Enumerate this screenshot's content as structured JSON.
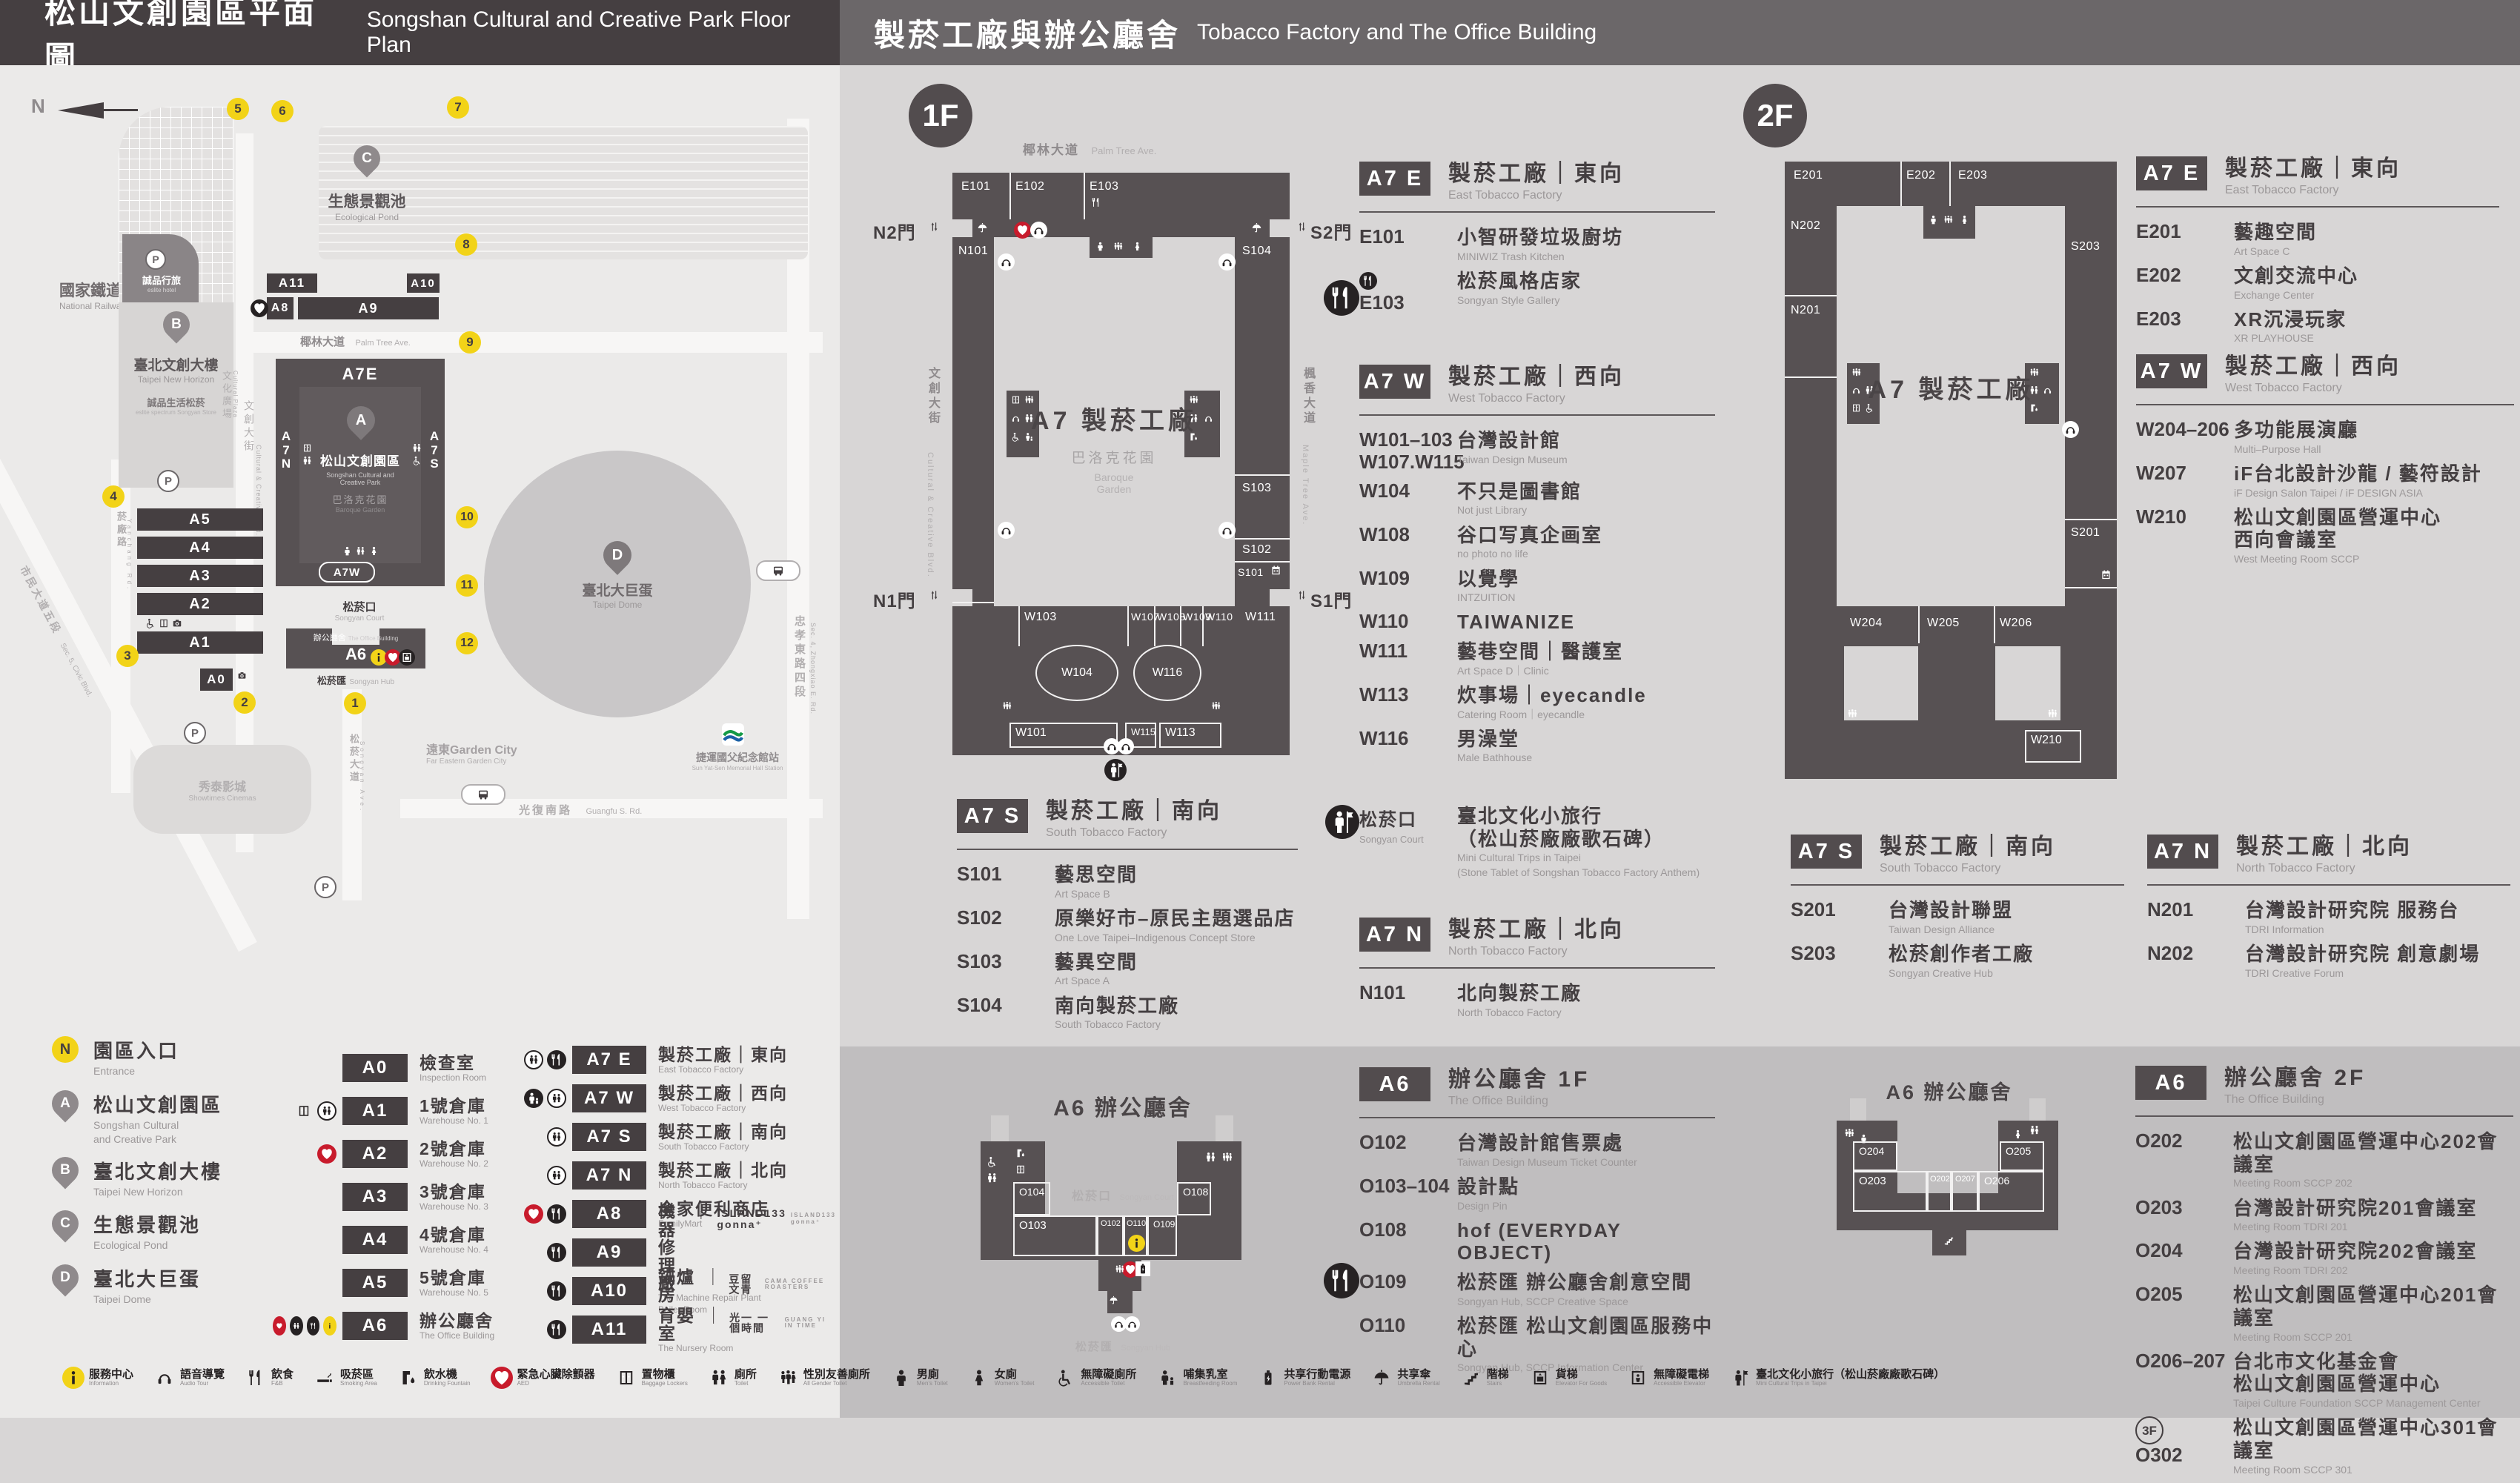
{
  "header": {
    "left_zh": "松山文創園區平面圖",
    "left_en": "Songshan Cultural and Creative Park Floor Plan",
    "right_zh": "製菸工廠與辦公廳舍",
    "right_en": "Tobacco Factory and The Office Building"
  },
  "map": {
    "north": "N",
    "railway_zh": "國家鐵道博物館",
    "railway_en": "National Railway Museum",
    "pond_zh": "生態景觀池",
    "pond_en": "Ecological Pond",
    "hotel_zh": "誠品行旅",
    "hotel_en": "eslite hotel",
    "b_zh": "臺北文創大樓",
    "b_en": "Taipei New Horizon",
    "spectrum_zh": "誠品生活松菸",
    "spectrum_en": "eslite spectrum Songyan Store",
    "plaza_zh": "文化廣場",
    "plaza_en": "Cultural Plaza",
    "ccb_zh": "文創大街",
    "ccb_en": "Cultural & Creative Blvd.",
    "palm_zh": "椰林大道",
    "palm_en": "Palm Tree Ave.",
    "park_zh": "松山文創園區",
    "park_en1": "Songshan Cultural and",
    "park_en2": "Creative Park",
    "baroque_zh": "巴洛克花園",
    "baroque_en": "Baroque Garden",
    "court_zh": "松菸口",
    "court_en": "Songyan Court",
    "office_zh": "辦公廳舍",
    "office_en": "The Office Building",
    "hub_zh": "松菸匯",
    "hub_en": "Songyan Hub",
    "dome_zh": "臺北大巨蛋",
    "dome_en": "Taipei Dome",
    "garden_city_zh": "遠東Garden City",
    "garden_city_en": "Far Eastern Garden City",
    "cinema_zh": "秀泰影城",
    "cinema_en": "Showtimes Cinemas",
    "mrt_zh": "捷運國父紀念館站",
    "mrt_en": "Sun Yat-Sen Memorial Hall Station",
    "guangfu_zh": "光復南路",
    "guangfu_en": "Guangfu S. Rd.",
    "zhongxiao_zh": "忠孝東路四段",
    "zhongxiao_en": "Sec. 4, Zhongxiao E. Rd.",
    "yanchang_zh": "菸廠路",
    "yanchang_en": "Yanchang Rd.",
    "civic_zh": "市民大道五段",
    "civic_en": "Sec. 5, Civic Blvd.",
    "songyan_ave_zh": "松菸大道",
    "songyan_ave_en": "Songyan Ave.",
    "a7e": "A7E",
    "a7w": "A7W",
    "a7n": "A7N",
    "a7s": "A7S",
    "bars": {
      "a0": "A0",
      "a1": "A1",
      "a2": "A2",
      "a3": "A3",
      "a4": "A4",
      "a5": "A5",
      "a6": "A6",
      "a8": "A8",
      "a9": "A9",
      "a10": "A10",
      "a11": "A11"
    },
    "pins": {
      "a": "A",
      "b": "B",
      "c": "C",
      "d": "D"
    },
    "gates": [
      "1",
      "2",
      "3",
      "4",
      "5",
      "6",
      "7",
      "8",
      "9",
      "10",
      "11",
      "12"
    ],
    "p": "P"
  },
  "floor1": {
    "badge": "1F",
    "street_top_zh": "椰林大道",
    "street_top_en": "Palm Tree Ave.",
    "street_left_zh": "文創大街",
    "street_left_en": "Cultural & Creative Blvd.",
    "street_right_zh": "楓香大道",
    "street_right_en": "Maple Tree Ave.",
    "gate_n2": "N2門",
    "gate_s2": "S2門",
    "gate_n1": "N1門",
    "gate_s1": "S1門",
    "plan_title": "A7 製菸工廠",
    "garden_zh": "巴洛克花園",
    "garden_en1": "Baroque",
    "garden_en2": "Garden",
    "plan": {
      "E101": "E101",
      "E102": "E102",
      "E103": "E103",
      "N101": "N101",
      "S101": "S101",
      "S102": "S102",
      "S103": "S103",
      "S104": "S104",
      "W101": "W101",
      "W102": "W102",
      "W103": "W103",
      "W104": "W104",
      "W107": "W107",
      "W108": "W108",
      "W109": "W109",
      "W110": "W110",
      "W111": "W111",
      "W113": "W113",
      "W115": "W115",
      "W116": "W116"
    }
  },
  "floor2": {
    "badge": "2F",
    "plan_title": "A7 製菸工廠",
    "plan": {
      "E201": "E201",
      "E202": "E202",
      "E203": "E203",
      "N201": "N201",
      "N202": "N202",
      "S201": "S201",
      "S203": "S203",
      "W204": "W204",
      "W205": "W205",
      "W206": "W206",
      "W207": "W207",
      "W208": "W208",
      "W210": "W210"
    }
  },
  "a6map1f": {
    "title": "A6 辦公廳舍",
    "court_zh": "松菸口",
    "court_en": "Songyan Court",
    "hub_zh": "松菸匯",
    "hub_en": "Songyan Hub",
    "rooms": {
      "O102": "O102",
      "O103": "O103",
      "O104": "O104",
      "O108": "O108",
      "O109": "O109",
      "O110": "O110"
    }
  },
  "a6map2f": {
    "title": "A6 辦公廳舍",
    "rooms": {
      "O202": "O202",
      "O203": "O203",
      "O204": "O204",
      "O205": "O205",
      "O206": "O206",
      "O207": "O207"
    }
  },
  "sections": {
    "f1e": {
      "badge": "A7 E",
      "zh": "製菸工廠｜東向",
      "en": "East Tobacco Factory",
      "entries": [
        {
          "code": "E101",
          "zh": "小智研發垃圾廚坊",
          "en": "MINIWIZ Trash Kitchen"
        },
        {
          "code": "E103",
          "zh": "松菸風格店家",
          "en": "Songyan Style Gallery",
          "prefix_icon": "food-icon"
        }
      ]
    },
    "f1w": {
      "badge": "A7 W",
      "zh": "製菸工廠｜西向",
      "en": "West Tobacco Factory",
      "entries": [
        {
          "code": "W101–103",
          "code2": "W107.W115",
          "zh": "台灣設計館",
          "en": "Taiwan Design Museum"
        },
        {
          "code": "W104",
          "zh": "不只是圖書館",
          "en": "Not just Library"
        },
        {
          "code": "W108",
          "zh": "谷口写真企画室",
          "en": "no photo no life"
        },
        {
          "code": "W109",
          "zh": "以覺學",
          "en": "INTZUITION"
        },
        {
          "code": "W110",
          "zh": "TAIWANIZE"
        },
        {
          "code": "W111",
          "zh": "藝巷空間｜醫護室",
          "en": "Art Space D｜Clinic"
        },
        {
          "code": "W113",
          "zh": "炊事場｜eyecandle",
          "en": "Catering Room｜eyecandle"
        },
        {
          "code": "W116",
          "zh": "男澡堂",
          "en": "Male Bathhouse"
        }
      ]
    },
    "court": {
      "zh": "松菸口",
      "en": "Songyan Court",
      "name_zh": "臺北文化小旅行",
      "name_zh2": "（松山菸廠廠歌石碑）",
      "name_en": "Mini Cultural Trips in Taipei",
      "name_en2": "(Stone Tablet of Songshan Tobacco Factory Anthem)"
    },
    "f1n": {
      "badge": "A7 N",
      "zh": "製菸工廠｜北向",
      "en": "North Tobacco Factory",
      "entries": [
        {
          "code": "N101",
          "zh": "北向製菸工廠",
          "en": "North Tobacco Factory"
        }
      ]
    },
    "f1s": {
      "badge": "A7 S",
      "zh": "製菸工廠｜南向",
      "en": "South Tobacco Factory",
      "entries": [
        {
          "code": "S101",
          "zh": "藝思空間",
          "en": "Art Space B"
        },
        {
          "code": "S102",
          "zh": "原樂好市–原民主題選品店",
          "en": "One Love Taipei–Indigenous Concept Store"
        },
        {
          "code": "S103",
          "zh": "藝異空間",
          "en": "Art Space A"
        },
        {
          "code": "S104",
          "zh": "南向製菸工廠",
          "en": "South Tobacco Factory"
        }
      ]
    },
    "a61f": {
      "badge": "A6",
      "zh": "辦公廳舍 1F",
      "en": "The Office Building",
      "entries": [
        {
          "code": "O102",
          "zh": "台灣設計館售票處",
          "en": "Taiwan Design Museum Ticket Counter"
        },
        {
          "code": "O103–104",
          "zh": "設計點",
          "en": "Design Pin"
        },
        {
          "code": "O108",
          "zh": "hof (EVERYDAY OBJECT)"
        },
        {
          "code": "O109",
          "zh": "松菸匯 辦公廳舍創意空間",
          "en": "Songyan Hub, SCCP Creative Space"
        },
        {
          "code": "O110",
          "zh": "松菸匯 松山文創園區服務中心",
          "en": "Songyan Hub, SCCP Information Center"
        }
      ]
    },
    "f2e": {
      "badge": "A7 E",
      "zh": "製菸工廠｜東向",
      "en": "East Tobacco Factory",
      "entries": [
        {
          "code": "E201",
          "zh": "藝趣空間",
          "en": "Art Space C"
        },
        {
          "code": "E202",
          "zh": "文創交流中心",
          "en": "Exchange Center"
        },
        {
          "code": "E203",
          "zh": "XR沉浸玩家",
          "en": "XR PLAYHOUSE"
        }
      ]
    },
    "f2w": {
      "badge": "A7 W",
      "zh": "製菸工廠｜西向",
      "en": "West Tobacco Factory",
      "entries": [
        {
          "code": "W204–206",
          "zh": "多功能展演廳",
          "en": "Multi–Purpose Hall"
        },
        {
          "code": "W207",
          "zh": "iF台北設計沙龍 / 藝符設計",
          "en": "iF Design Salon Taipei / iF DESIGN ASIA"
        },
        {
          "code": "W210",
          "zh": "松山文創園區營運中心",
          "zh2": "西向會議室",
          "en": "West Meeting Room SCCP"
        }
      ]
    },
    "f2s": {
      "badge": "A7 S",
      "zh": "製菸工廠｜南向",
      "en": "South Tobacco Factory",
      "entries": [
        {
          "code": "S201",
          "zh": "台灣設計聯盟",
          "en": "Taiwan Design Alliance"
        },
        {
          "code": "S203",
          "zh": "松菸創作者工廠",
          "en": "Songyan Creative Hub"
        }
      ]
    },
    "f2n": {
      "badge": "A7 N",
      "zh": "製菸工廠｜北向",
      "en": "North Tobacco Factory",
      "entries": [
        {
          "code": "N201",
          "zh": "台灣設計研究院 服務台",
          "en": "TDRI Information"
        },
        {
          "code": "N202",
          "zh": "台灣設計研究院 創意劇場",
          "en": "TDRI Creative Forum"
        }
      ]
    },
    "a62f": {
      "badge": "A6",
      "zh": "辦公廳舍 2F",
      "en": "The Office Building",
      "entries": [
        {
          "code": "O202",
          "zh": "松山文創園區營運中心202會議室",
          "en": "Meeting Room SCCP 202"
        },
        {
          "code": "O203",
          "zh": "台灣設計研究院201會議室",
          "en": "Meeting Room TDRI 201"
        },
        {
          "code": "O204",
          "zh": "台灣設計研究院202會議室",
          "en": "Meeting Room TDRI 202"
        },
        {
          "code": "O205",
          "zh": "松山文創園區營運中心201會議室",
          "en": "Meeting Room SCCP 201"
        },
        {
          "code": "O206–207",
          "zh": "台北市文化基金會",
          "zh2": "松山文創園區營運中心",
          "en": "Taipei Culture Foundation SCCP Management Center"
        },
        {
          "code": "O302",
          "zh": "松山文創園區營運中心301會議室",
          "en": "Meeting Room SCCP 301",
          "prefix_text": "3F"
        }
      ]
    }
  },
  "legend": {
    "places": [
      {
        "key": "N",
        "zh": "園區入口",
        "en": "Entrance"
      },
      {
        "key": "A",
        "zh": "松山文創園區",
        "en": "Songshan Cultural",
        "en2": "and Creative Park"
      },
      {
        "key": "B",
        "zh": "臺北文創大樓",
        "en": "Taipei New Horizon"
      },
      {
        "key": "C",
        "zh": "生態景觀池",
        "en": "Ecological Pond"
      },
      {
        "key": "D",
        "zh": "臺北大巨蛋",
        "en": "Taipei Dome"
      }
    ],
    "buildings": [
      {
        "badge": "A0",
        "zh": "檢查室",
        "en": "Inspection Room",
        "icons": []
      },
      {
        "badge": "A1",
        "zh": "1號倉庫",
        "en": "Warehouse No. 1",
        "icons": [
          "n:locker-icon",
          "o:toilet-icon"
        ]
      },
      {
        "badge": "A2",
        "zh": "2號倉庫",
        "en": "Warehouse No. 2",
        "icons": [
          "r:aed-icon"
        ]
      },
      {
        "badge": "A3",
        "zh": "3號倉庫",
        "en": "Warehouse No. 3",
        "icons": []
      },
      {
        "badge": "A4",
        "zh": "4號倉庫",
        "en": "Warehouse No. 4",
        "icons": []
      },
      {
        "badge": "A5",
        "zh": "5號倉庫",
        "en": "Warehouse No. 5",
        "icons": []
      },
      {
        "badge": "A6",
        "zh": "辦公廳舍",
        "en": "The Office Building",
        "icons": [
          "r:aed-icon",
          "b:toilet-icon",
          "b:food-icon",
          "y:info-icon"
        ]
      }
    ],
    "venues": [
      {
        "badge": "A7 E",
        "zh": "製菸工廠｜東向",
        "en": "East Tobacco Factory",
        "icons": [
          "o:toilet-icon",
          "b:food-icon"
        ]
      },
      {
        "badge": "A7 W",
        "zh": "製菸工廠｜西向",
        "en": "West Tobacco Factory",
        "icons": [
          "b:nursing-icon",
          "o:toilet-icon"
        ]
      },
      {
        "badge": "A7 S",
        "zh": "製菸工廠｜南向",
        "en": "South Tobacco Factory",
        "icons": [
          "o:toilet-icon"
        ]
      },
      {
        "badge": "A7 N",
        "zh": "製菸工廠｜北向",
        "en": "North Tobacco Factory",
        "icons": [
          "o:toilet-icon"
        ]
      },
      {
        "badge": "A8",
        "zh": "全家便利商店",
        "en": "FamilyMart",
        "icons": [
          "r:aed-icon",
          "b:food-icon"
        ]
      },
      {
        "badge": "A9",
        "zh": "機器修理廠",
        "en": "The Machine Repair Plant",
        "brand_zh": "ISLAND133 gonna⁺",
        "brand_en": "ISLAND133 gonna⁺",
        "icons": [
          "b:food-icon"
        ]
      },
      {
        "badge": "A10",
        "zh": "鍋爐房",
        "en": "Boiler Room",
        "brand_zh": "豆留文青",
        "brand_en": "CAMA COFFEE ROASTERS",
        "icons": [
          "b:food-icon"
        ]
      },
      {
        "badge": "A11",
        "zh": "育嬰室",
        "en": "The Nursery Room",
        "brand_zh": "光一 一個時間",
        "brand_en": "GUANG YI IN TIME",
        "icons": [
          "b:food-icon"
        ]
      }
    ],
    "facilities": [
      {
        "icon": "info-icon",
        "cls": "y",
        "zh": "服務中心",
        "en": "Information"
      },
      {
        "icon": "audio-tour-icon",
        "zh": "語音導覽",
        "en": "Audio Tour"
      },
      {
        "icon": "food-icon",
        "zh": "飲食",
        "en": "F&B"
      },
      {
        "icon": "smoking-icon",
        "zh": "吸菸區",
        "en": "Smoking Area"
      },
      {
        "icon": "fountain-icon",
        "zh": "飲水機",
        "en": "Drinking Fountain"
      },
      {
        "icon": "aed-icon",
        "cls": "r",
        "zh": "緊急心臟除顫器",
        "en": "AED"
      },
      {
        "icon": "locker-icon",
        "zh": "置物櫃",
        "en": "Baggage Lockers"
      },
      {
        "icon": "toilet-icon",
        "zh": "廁所",
        "en": "Toilet"
      },
      {
        "icon": "all-gender-icon",
        "zh": "性別友善廁所",
        "en": "All Gender Toilet"
      },
      {
        "icon": "mens-icon",
        "zh": "男廁",
        "en": "Men's Toilet"
      },
      {
        "icon": "womens-icon",
        "zh": "女廁",
        "en": "Women's Toilet"
      },
      {
        "icon": "accessible-icon",
        "zh": "無障礙廁所",
        "en": "Accessible Toilet"
      },
      {
        "icon": "nursing-icon",
        "zh": "哺集乳室",
        "en": "Breastfeeding Room"
      },
      {
        "icon": "power-bank-icon",
        "zh": "共享行動電源",
        "en": "Power Bank Rental"
      },
      {
        "icon": "umbrella-icon",
        "zh": "共享傘",
        "en": "Umbrella Rental"
      },
      {
        "icon": "stairs-icon",
        "zh": "階梯",
        "en": "Stairs"
      },
      {
        "icon": "cargo-lift-icon",
        "zh": "貨梯",
        "en": "Elevator For Goods"
      },
      {
        "icon": "accessible-lift-icon",
        "zh": "無障礙電梯",
        "en": "Accessible Elevator"
      },
      {
        "icon": "tour-icon",
        "zh": "臺北文化小旅行（松山菸廠廠歌石碑）",
        "en": "Mini Cultural Trips in Taipei"
      }
    ]
  }
}
